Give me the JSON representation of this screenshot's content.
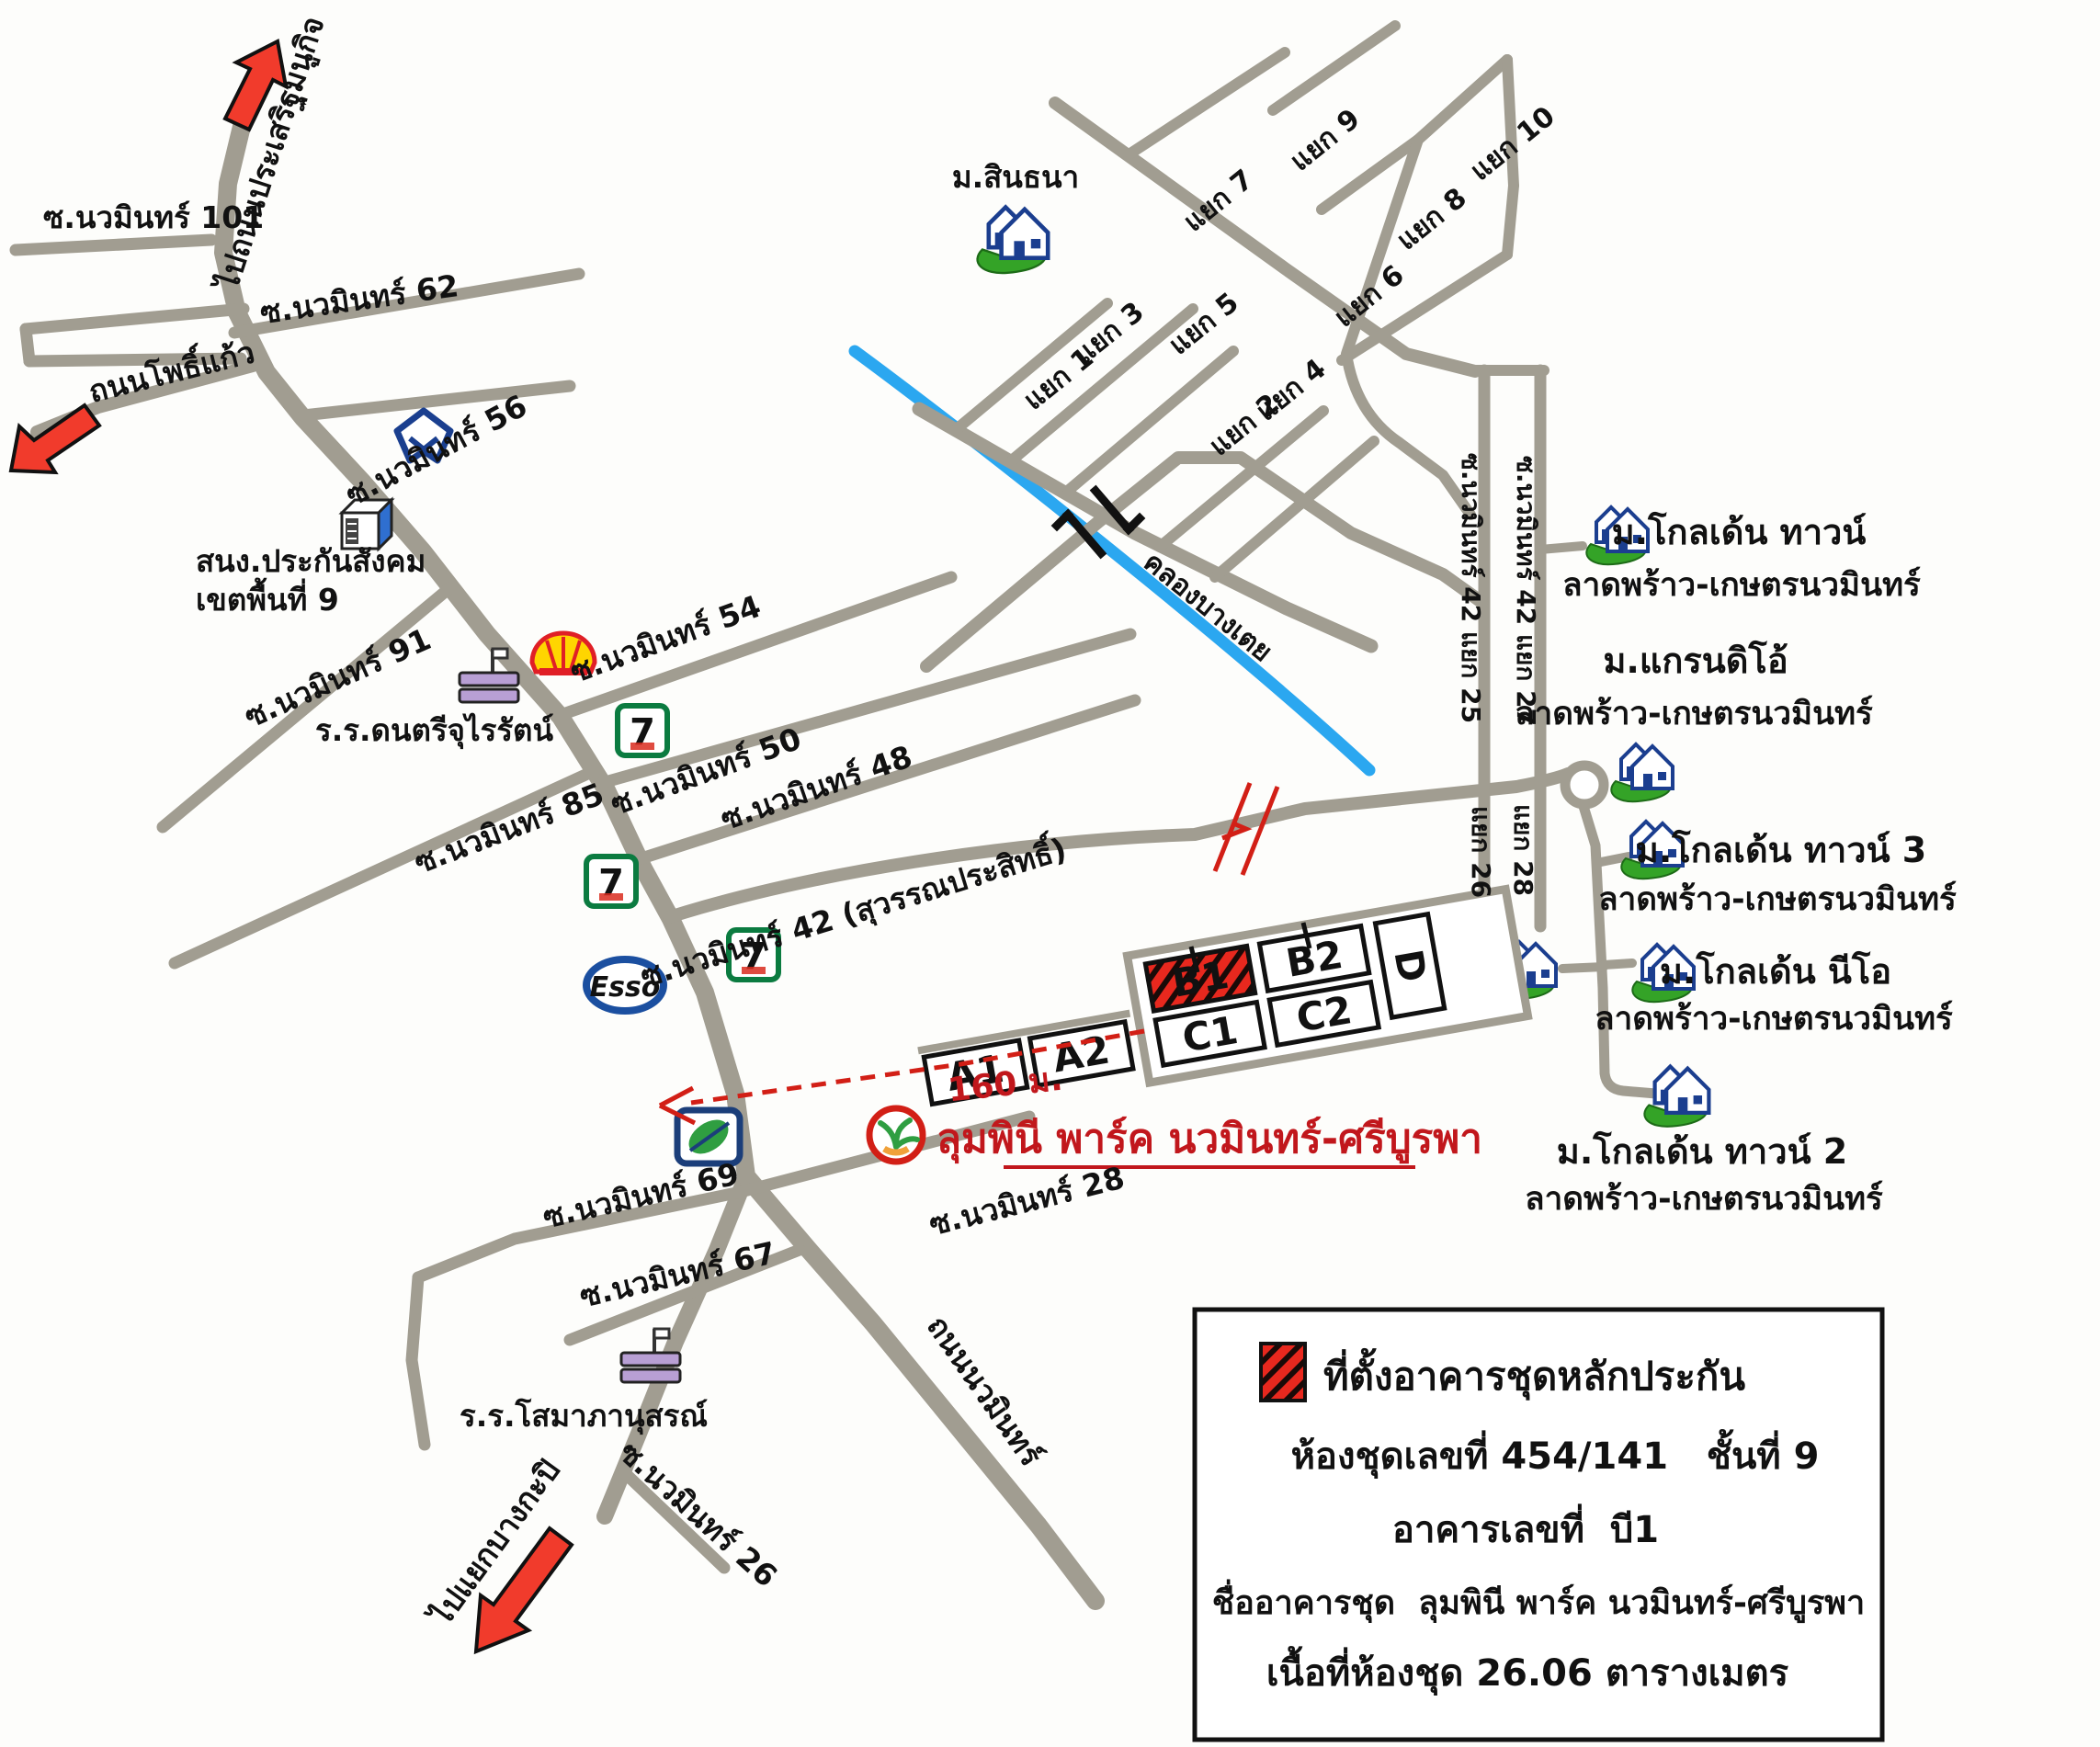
{
  "labels": {
    "to_prasert_manukit": "ไปถนนประเสริฐมนูกิจ",
    "soi_101": "ซ.นวมินทร์ 101",
    "soi_62": "ซ.นวมินทร์ 62",
    "phokaeo_road": "ถนนโพธิ์แก้ว",
    "sso_line1": "สนง.ประกันสังคม",
    "sso_line2": "เขตพื้นที่ 9",
    "soi_56": "ซ.นวมินทร์ 56",
    "soi_91": "ซ.นวมินทร์ 91",
    "churairat_school": "ร.ร.ดนตรีจุไรรัตน์",
    "soi_54": "ซ.นวมินทร์ 54",
    "soi_50": "ซ.นวมินทร์ 50",
    "soi_85": "ซ.นวมินทร์ 85",
    "soi_48": "ซ.นวมินทร์ 48",
    "soi_42": "ซ.นวมินทร์ 42 (สุวรรณประสิทธิ์)",
    "sinthana": "ม.สินธนา",
    "yaek_1": "แยก 1",
    "yaek_2": "แยก 2",
    "yaek_3": "แยก 3",
    "yaek_4": "แยก 4",
    "yaek_5": "แยก 5",
    "yaek_6": "แยก 6",
    "yaek_7": "แยก 7",
    "yaek_8": "แยก 8",
    "yaek_9": "แยก 9",
    "yaek_10": "แยก 10",
    "khlong": "คลองบางเตย",
    "soi42_yaek25": "ซ.นวมินทร์ 42 แยก 25",
    "soi42_yaek27": "ซ.นวมินทร์ 42 แยก 27",
    "yaek_26": "แยก 26",
    "yaek_28": "แยก 28",
    "golden_town": "ม.โกลเด้น ทาวน์",
    "golden_town_sub": "ลาดพร้าว-เกษตรนวมินทร์",
    "grandio": "ม.แกรนดิโอ้",
    "grandio_sub": "ลาดพร้าว-เกษตรนวมินทร์",
    "golden_town3": "ม.โกลเด้น ทาวน์ 3",
    "golden_town3_sub": "ลาดพร้าว-เกษตรนวมินทร์",
    "golden_neo": "ม.โกลเด้น นีโอ",
    "golden_neo_sub": "ลาดพร้าว-เกษตรนวมินทร์",
    "golden_town2": "ม.โกลเด้น ทาวน์ 2",
    "golden_town2_sub": "ลาดพร้าว-เกษตรนวมินทร์",
    "distance": "160 ม.",
    "condo_name": "ลุมพินี พาร์ค นวมินทร์-ศรีบูรพา",
    "soi_69": "ซ.นวมินทร์ 69",
    "soi_67": "ซ.นวมินทร์ 67",
    "soi_28": "ซ.นวมินทร์ 28",
    "soi_26": "ซ.นวมินทร์ 26",
    "somapa_school": "ร.ร.โสมาภานุสรณ์",
    "nawamin_road": "ถนนนวมินทร์",
    "to_bangkapi": "ไปแยกบางกะปิ"
  },
  "buildings": {
    "a1": "A1",
    "a2": "A2",
    "b1": "B1",
    "b2": "B2",
    "c1": "C1",
    "c2": "C2",
    "d": "D"
  },
  "legend": {
    "line1": "ที่ตั้งอาคารชุดหลักประกัน",
    "line2": "ห้องชุดเลขที่ 454/141   ชั้นที่ 9",
    "line3": "อาคารเลขที่  บี1",
    "line4": "ชื่ออาคารชุด  ลุมพินี พาร์ค นวมินทร์-ศรีบูรพา",
    "line5": "เนื้อที่ห้องชุด 26.06 ตารางเมตร"
  },
  "icons": {
    "esso": "Esso",
    "seven": "7"
  },
  "colors": {
    "road": "#a19d91",
    "canal": "#2ba7f0",
    "highlight_red": "#e8281e",
    "label_red": "#c1171c",
    "house_green": "#34a327",
    "house_blue": "#1b3e8f"
  }
}
